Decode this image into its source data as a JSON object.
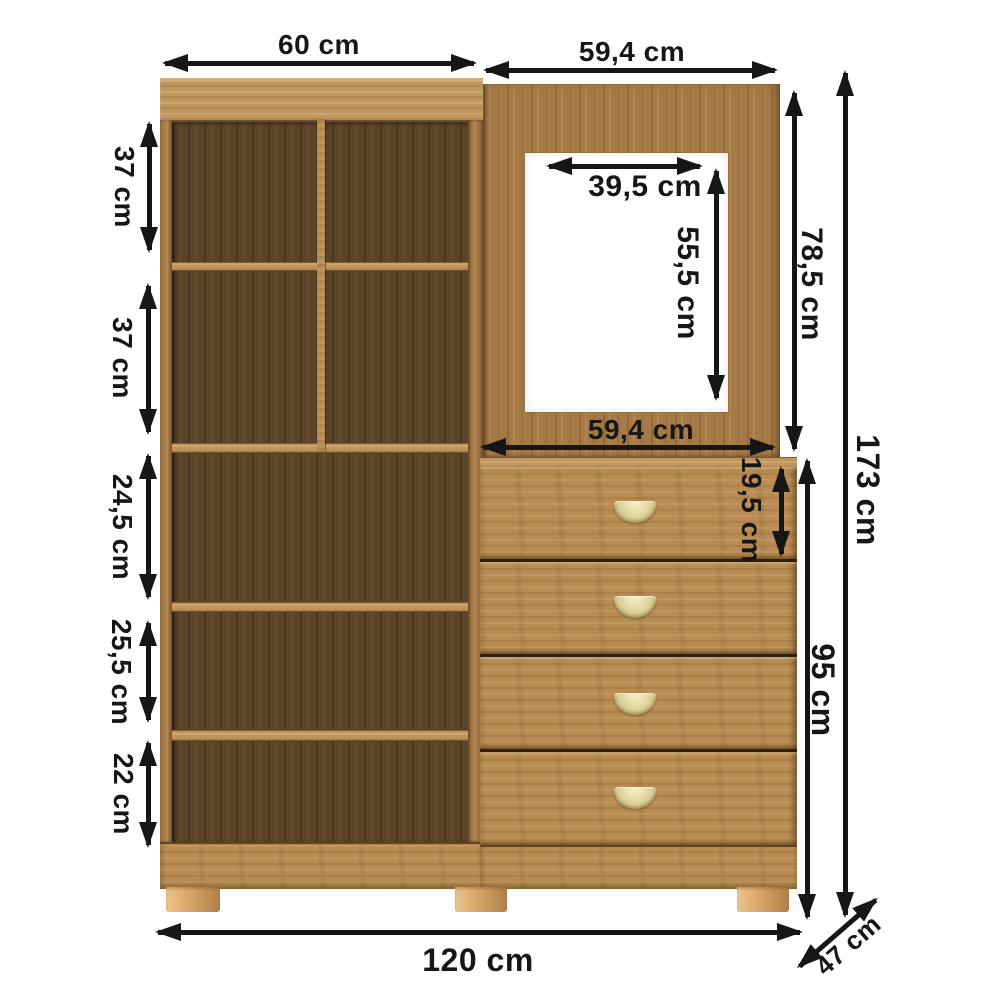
{
  "title": "Furniture dimension diagram",
  "units": "cm",
  "background_color": "#ffffff",
  "dimension_color": "#161616",
  "furniture": {
    "type": "wardrobe with open shelves, mirror panel and chest of 4 drawers",
    "shelf_rows": 5,
    "shelf_columns_top": 2,
    "drawers_count": 4,
    "feet_count": 3,
    "colors": {
      "wood_light": "#a97d48",
      "wood_board": "#c0955e",
      "wood_dark_interior": "#5c4428",
      "drawer_front": "#b88c52",
      "feet": "#dca76a",
      "handle_gold": "#ded19b",
      "mirror": "#ffffff"
    }
  },
  "dimensions": {
    "shelf_width": {
      "label": "60 cm",
      "value_cm": 60
    },
    "top_right_width": {
      "label": "59,4 cm",
      "value_cm": 59.4
    },
    "mirror_width": {
      "label": "39,5 cm",
      "value_cm": 39.5
    },
    "mirror_height": {
      "label": "55,5 cm",
      "value_cm": 55.5
    },
    "panel_height": {
      "label": "78,5 cm",
      "value_cm": 78.5
    },
    "drawer_section_width": {
      "label": "59,4 cm",
      "value_cm": 59.4
    },
    "top_drawer_height": {
      "label": "19,5 cm",
      "value_cm": 19.5
    },
    "drawer_unit_height": {
      "label": "95 cm",
      "value_cm": 95
    },
    "total_height": {
      "label": "173 cm",
      "value_cm": 173
    },
    "total_width": {
      "label": "120 cm",
      "value_cm": 120
    },
    "depth": {
      "label": "47 cm",
      "value_cm": 47
    },
    "shelf_row_1_height": {
      "label": "37 cm",
      "value_cm": 37
    },
    "shelf_row_2_height": {
      "label": "37 cm",
      "value_cm": 37
    },
    "shelf_row_3_height": {
      "label": "24,5 cm",
      "value_cm": 24.5
    },
    "shelf_row_4_height": {
      "label": "25,5 cm",
      "value_cm": 25.5
    },
    "shelf_row_5_height": {
      "label": "22 cm",
      "value_cm": 22
    }
  }
}
